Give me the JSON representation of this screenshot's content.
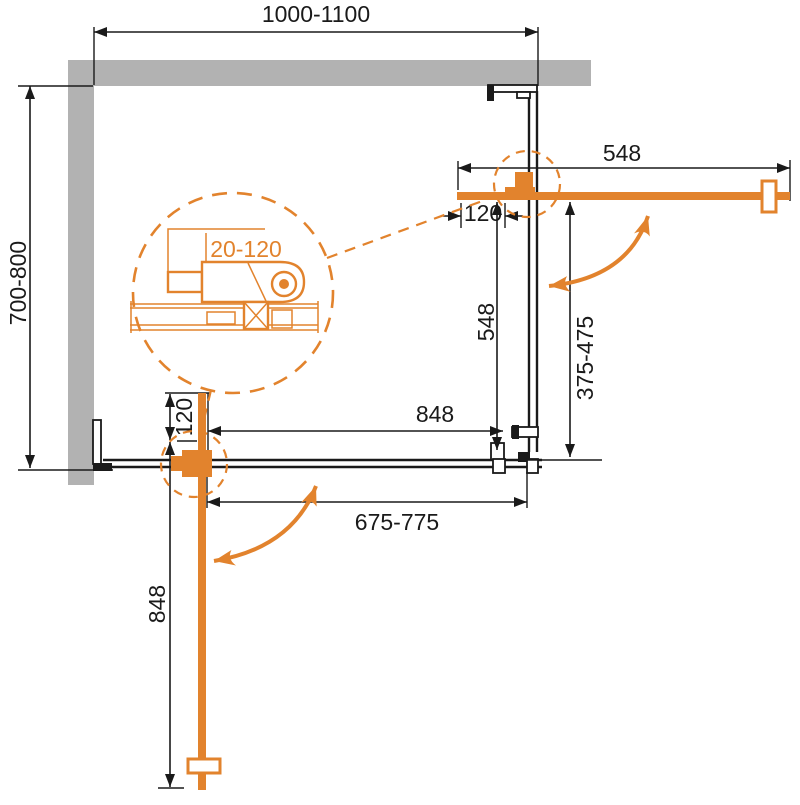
{
  "colors": {
    "accent": "#E2832D",
    "wall": "#B2B2B2",
    "line": "#1A1A1A",
    "background": "#FFFFFF"
  },
  "labels": {
    "overall_width": "1000-1100",
    "overall_depth": "700-800",
    "door_right_length": "548",
    "door_right_offset": "120",
    "panel_right_length": "548",
    "panel_right_range": "375-475",
    "panel_bottom_length": "848",
    "panel_bottom_range": "675-775",
    "door_bottom_offset": "120",
    "door_bottom_length": "848",
    "profile_adjust_range": "20-120"
  }
}
